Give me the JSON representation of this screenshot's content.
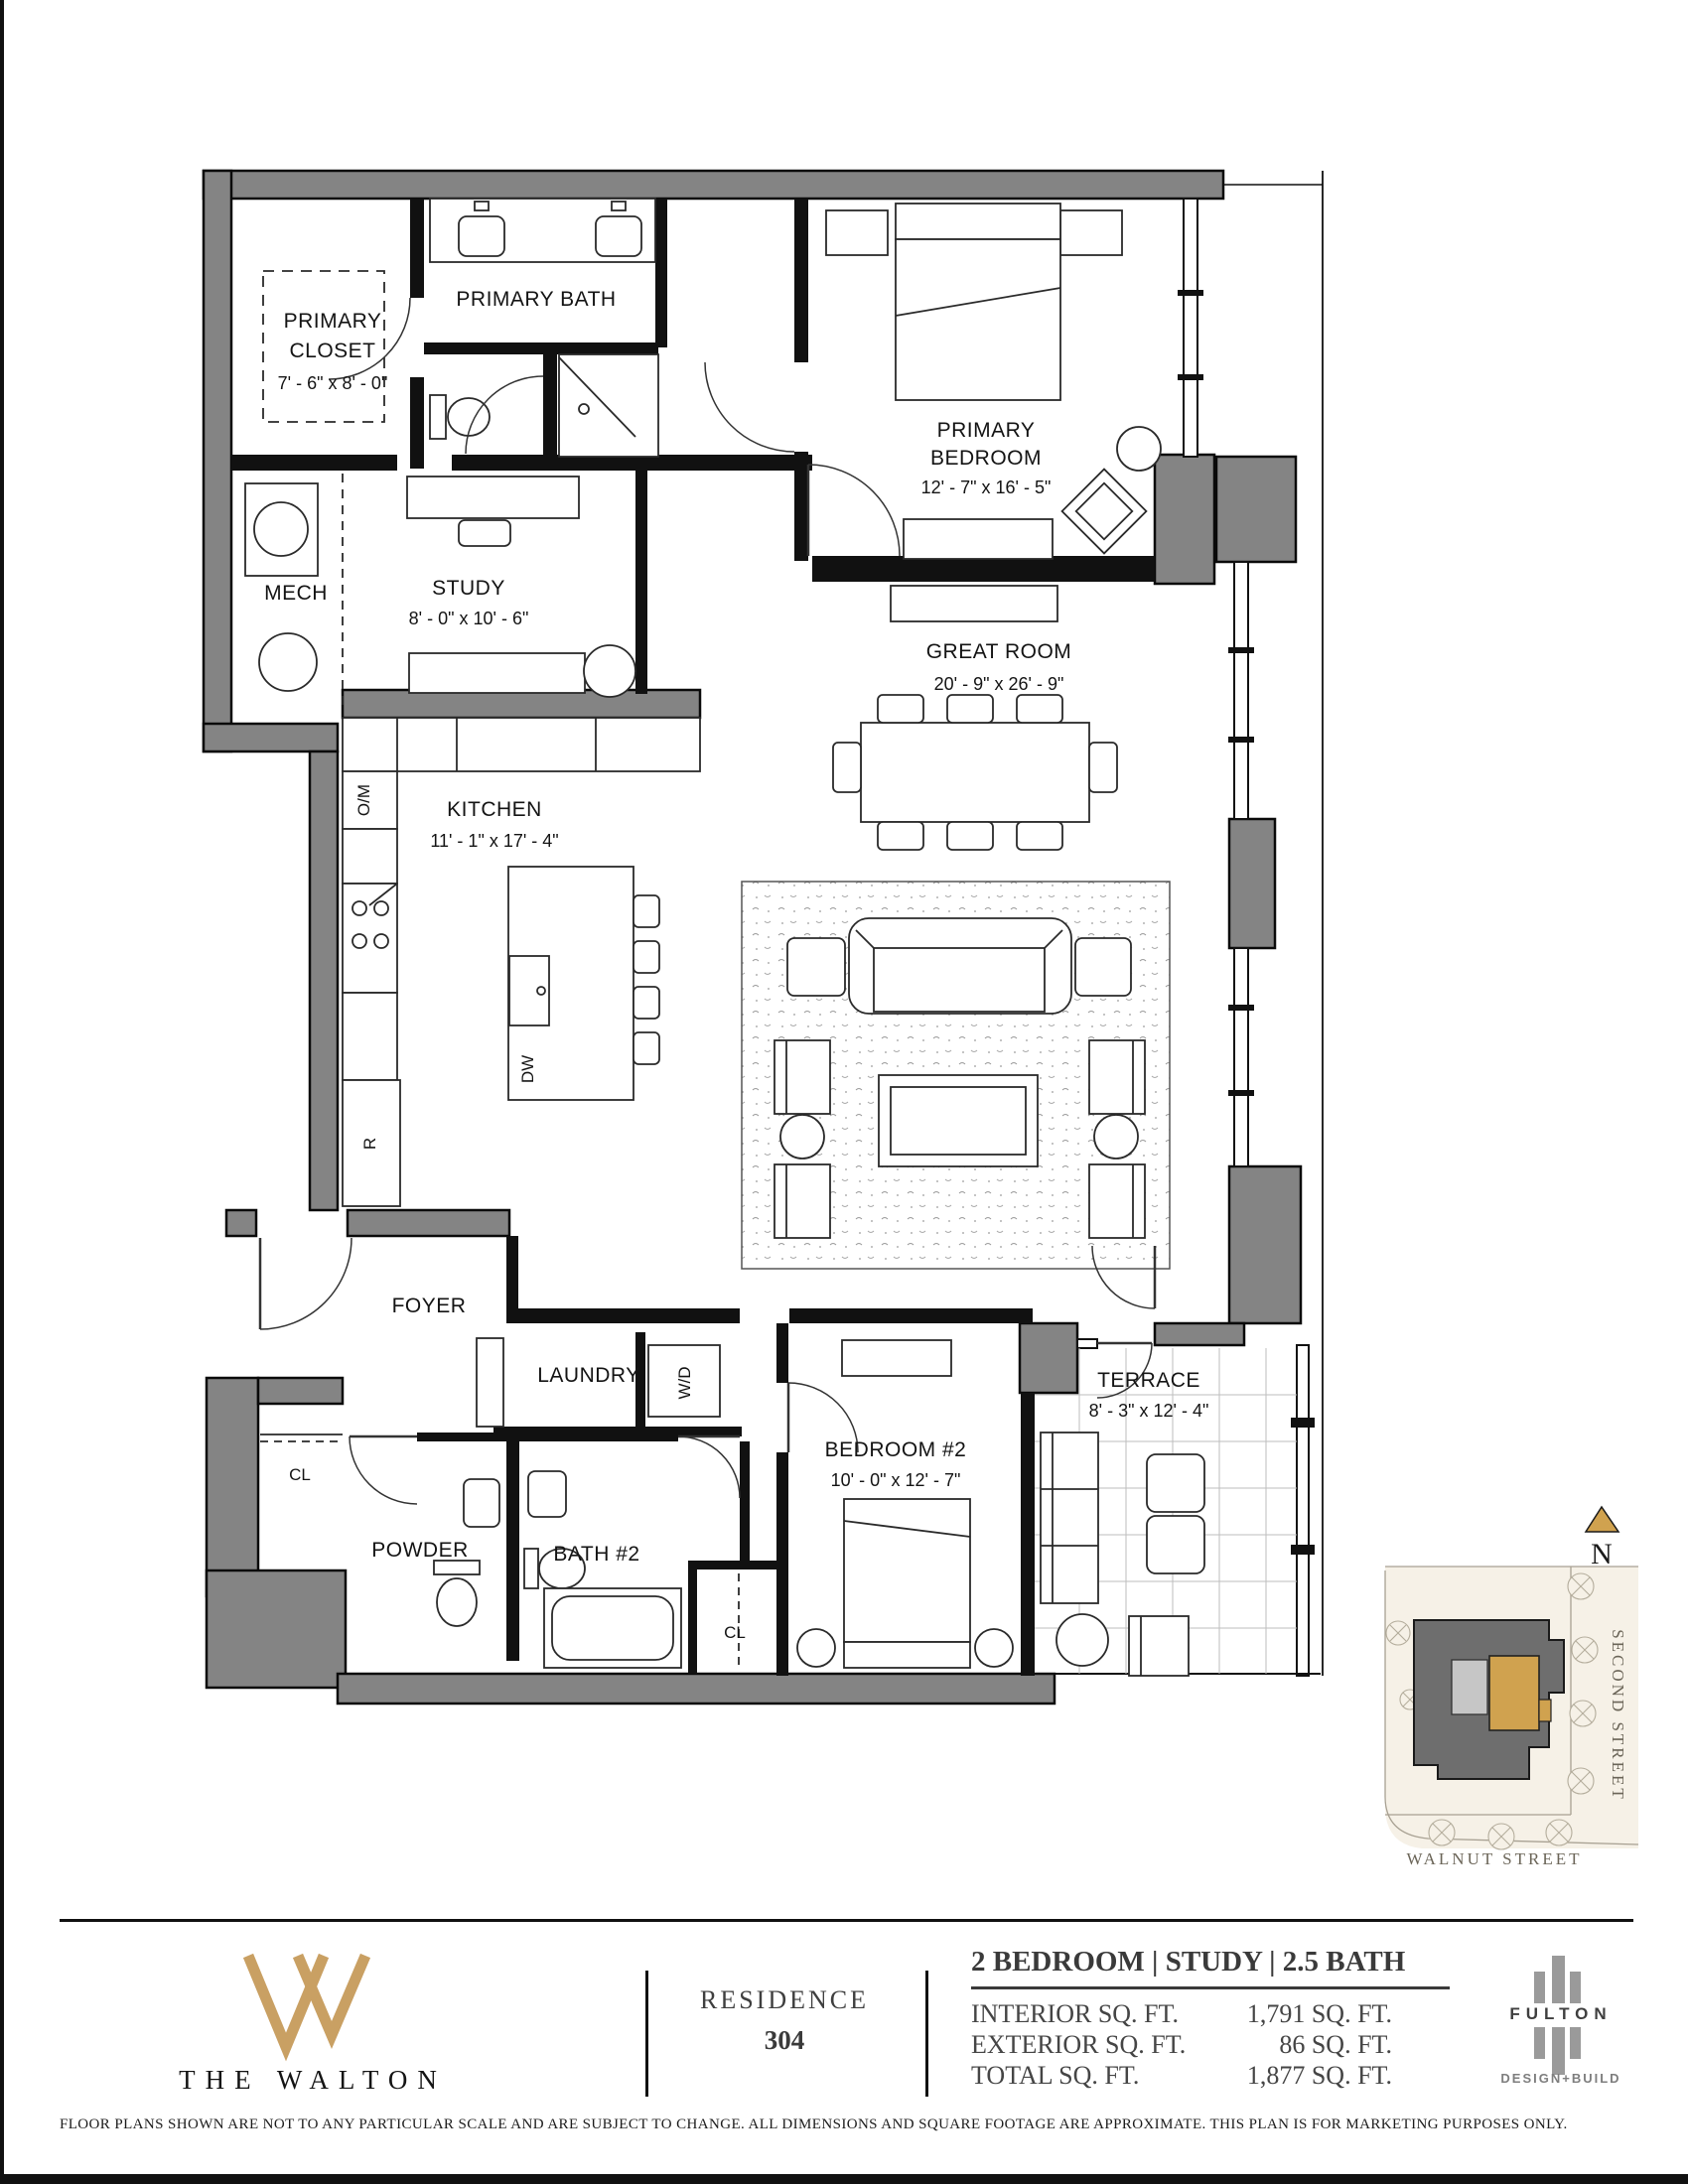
{
  "colors": {
    "wall_gray": "#848484",
    "accent_gold": "#c9a063",
    "unit_gold": "#d0a24f",
    "site_cream": "#f6f1e7"
  },
  "labels": {
    "primary_closet_1": "PRIMARY",
    "primary_closet_2": "CLOSET",
    "primary_closet_dims": "7' - 6\" x 8' - 0\"",
    "primary_bath": "PRIMARY BATH",
    "primary_bedroom_1": "PRIMARY",
    "primary_bedroom_2": "BEDROOM",
    "primary_bedroom_dims": "12' - 7\" x 16' - 5\"",
    "mech": "MECH",
    "study": "STUDY",
    "study_dims": "8' - 0\" x 10' - 6\"",
    "great_room": "GREAT ROOM",
    "great_room_dims": "20' - 9\" x 26' - 9\"",
    "kitchen": "KITCHEN",
    "kitchen_dims": "11' - 1\" x 17' - 4\"",
    "om": "O/M",
    "r": "R",
    "dw": "DW",
    "foyer": "FOYER",
    "laundry": "LAUNDRY",
    "wd": "W/D",
    "cl_entry": "CL",
    "powder": "POWDER",
    "bath2": "BATH #2",
    "cl_bed2": "CL",
    "bedroom2": "BEDROOM #2",
    "bedroom2_dims": "10' - 0\" x 12' - 7\"",
    "terrace": "TERRACE",
    "terrace_dims": "8' - 3\" x 12' - 4\"",
    "north": "N",
    "second_street": "SECOND STREET",
    "walnut_street": "WALNUT STREET"
  },
  "footer": {
    "brand": "THE WALTON",
    "residence_label": "RESIDENCE",
    "residence_number": "304",
    "unit_type": "2 BEDROOM | STUDY | 2.5 BATH",
    "metrics": [
      {
        "label": "INTERIOR SQ. FT.",
        "value": "1,791 SQ. FT."
      },
      {
        "label": "EXTERIOR SQ. FT.",
        "value": "86 SQ. FT."
      },
      {
        "label": "TOTAL SQ. FT.",
        "value": "1,877 SQ. FT."
      }
    ],
    "builder_name": "FULTON",
    "builder_sub": "DESIGN+BUILD",
    "disclaimer": "FLOOR PLANS SHOWN ARE NOT TO ANY PARTICULAR SCALE AND ARE SUBJECT TO CHANGE. ALL DIMENSIONS AND SQUARE FOOTAGE ARE APPROXIMATE. THIS PLAN IS FOR MARKETING PURPOSES ONLY."
  }
}
